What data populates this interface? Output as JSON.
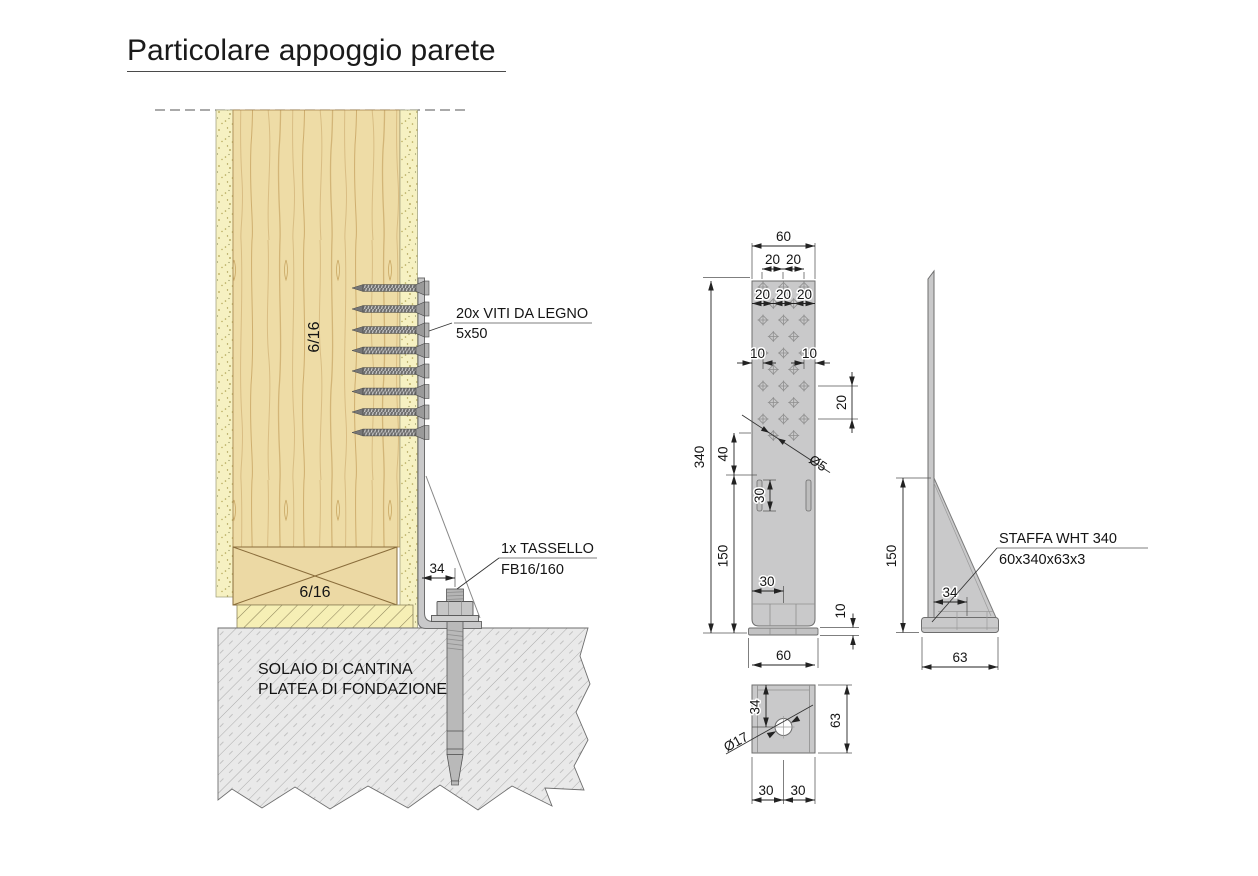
{
  "title": "Particolare appoggio parete",
  "section": {
    "panel_label": "6/16",
    "beam_label": "6/16",
    "screws_label1": "20x VITI DA LEGNO",
    "screws_label2": "5x50",
    "anchor_label1": "1x TASSELLO",
    "anchor_label2": "FB16/160",
    "anchor_offset": "34",
    "foundation1": "SOLAIO DI CANTINA",
    "foundation2": "PLATEA DI FONDAZIONE"
  },
  "front": {
    "width": "60",
    "pair": [
      "20",
      "20"
    ],
    "triple": [
      "20",
      "20",
      "20"
    ],
    "edges": [
      "10",
      "10"
    ],
    "row_gap": "20",
    "hole_dia": "Ø5",
    "height": "340",
    "upper": "40",
    "lower": "150",
    "slot": "30",
    "base_offset": "30",
    "base_th": "10",
    "base_width": "60"
  },
  "side": {
    "gusset": "150",
    "offset": "34",
    "depth": "63",
    "label1": "STAFFA WHT 340",
    "label2": "60x340x63x3"
  },
  "bottom": {
    "offset": "34",
    "hole_dia": "Ø17",
    "depth": "63",
    "halves": [
      "30",
      "30"
    ]
  },
  "colors": {
    "wood": "#ecd9a4",
    "insulation": "#f6f1c2",
    "steel": "#c9c9ca",
    "concrete": "#e9e9e9"
  }
}
